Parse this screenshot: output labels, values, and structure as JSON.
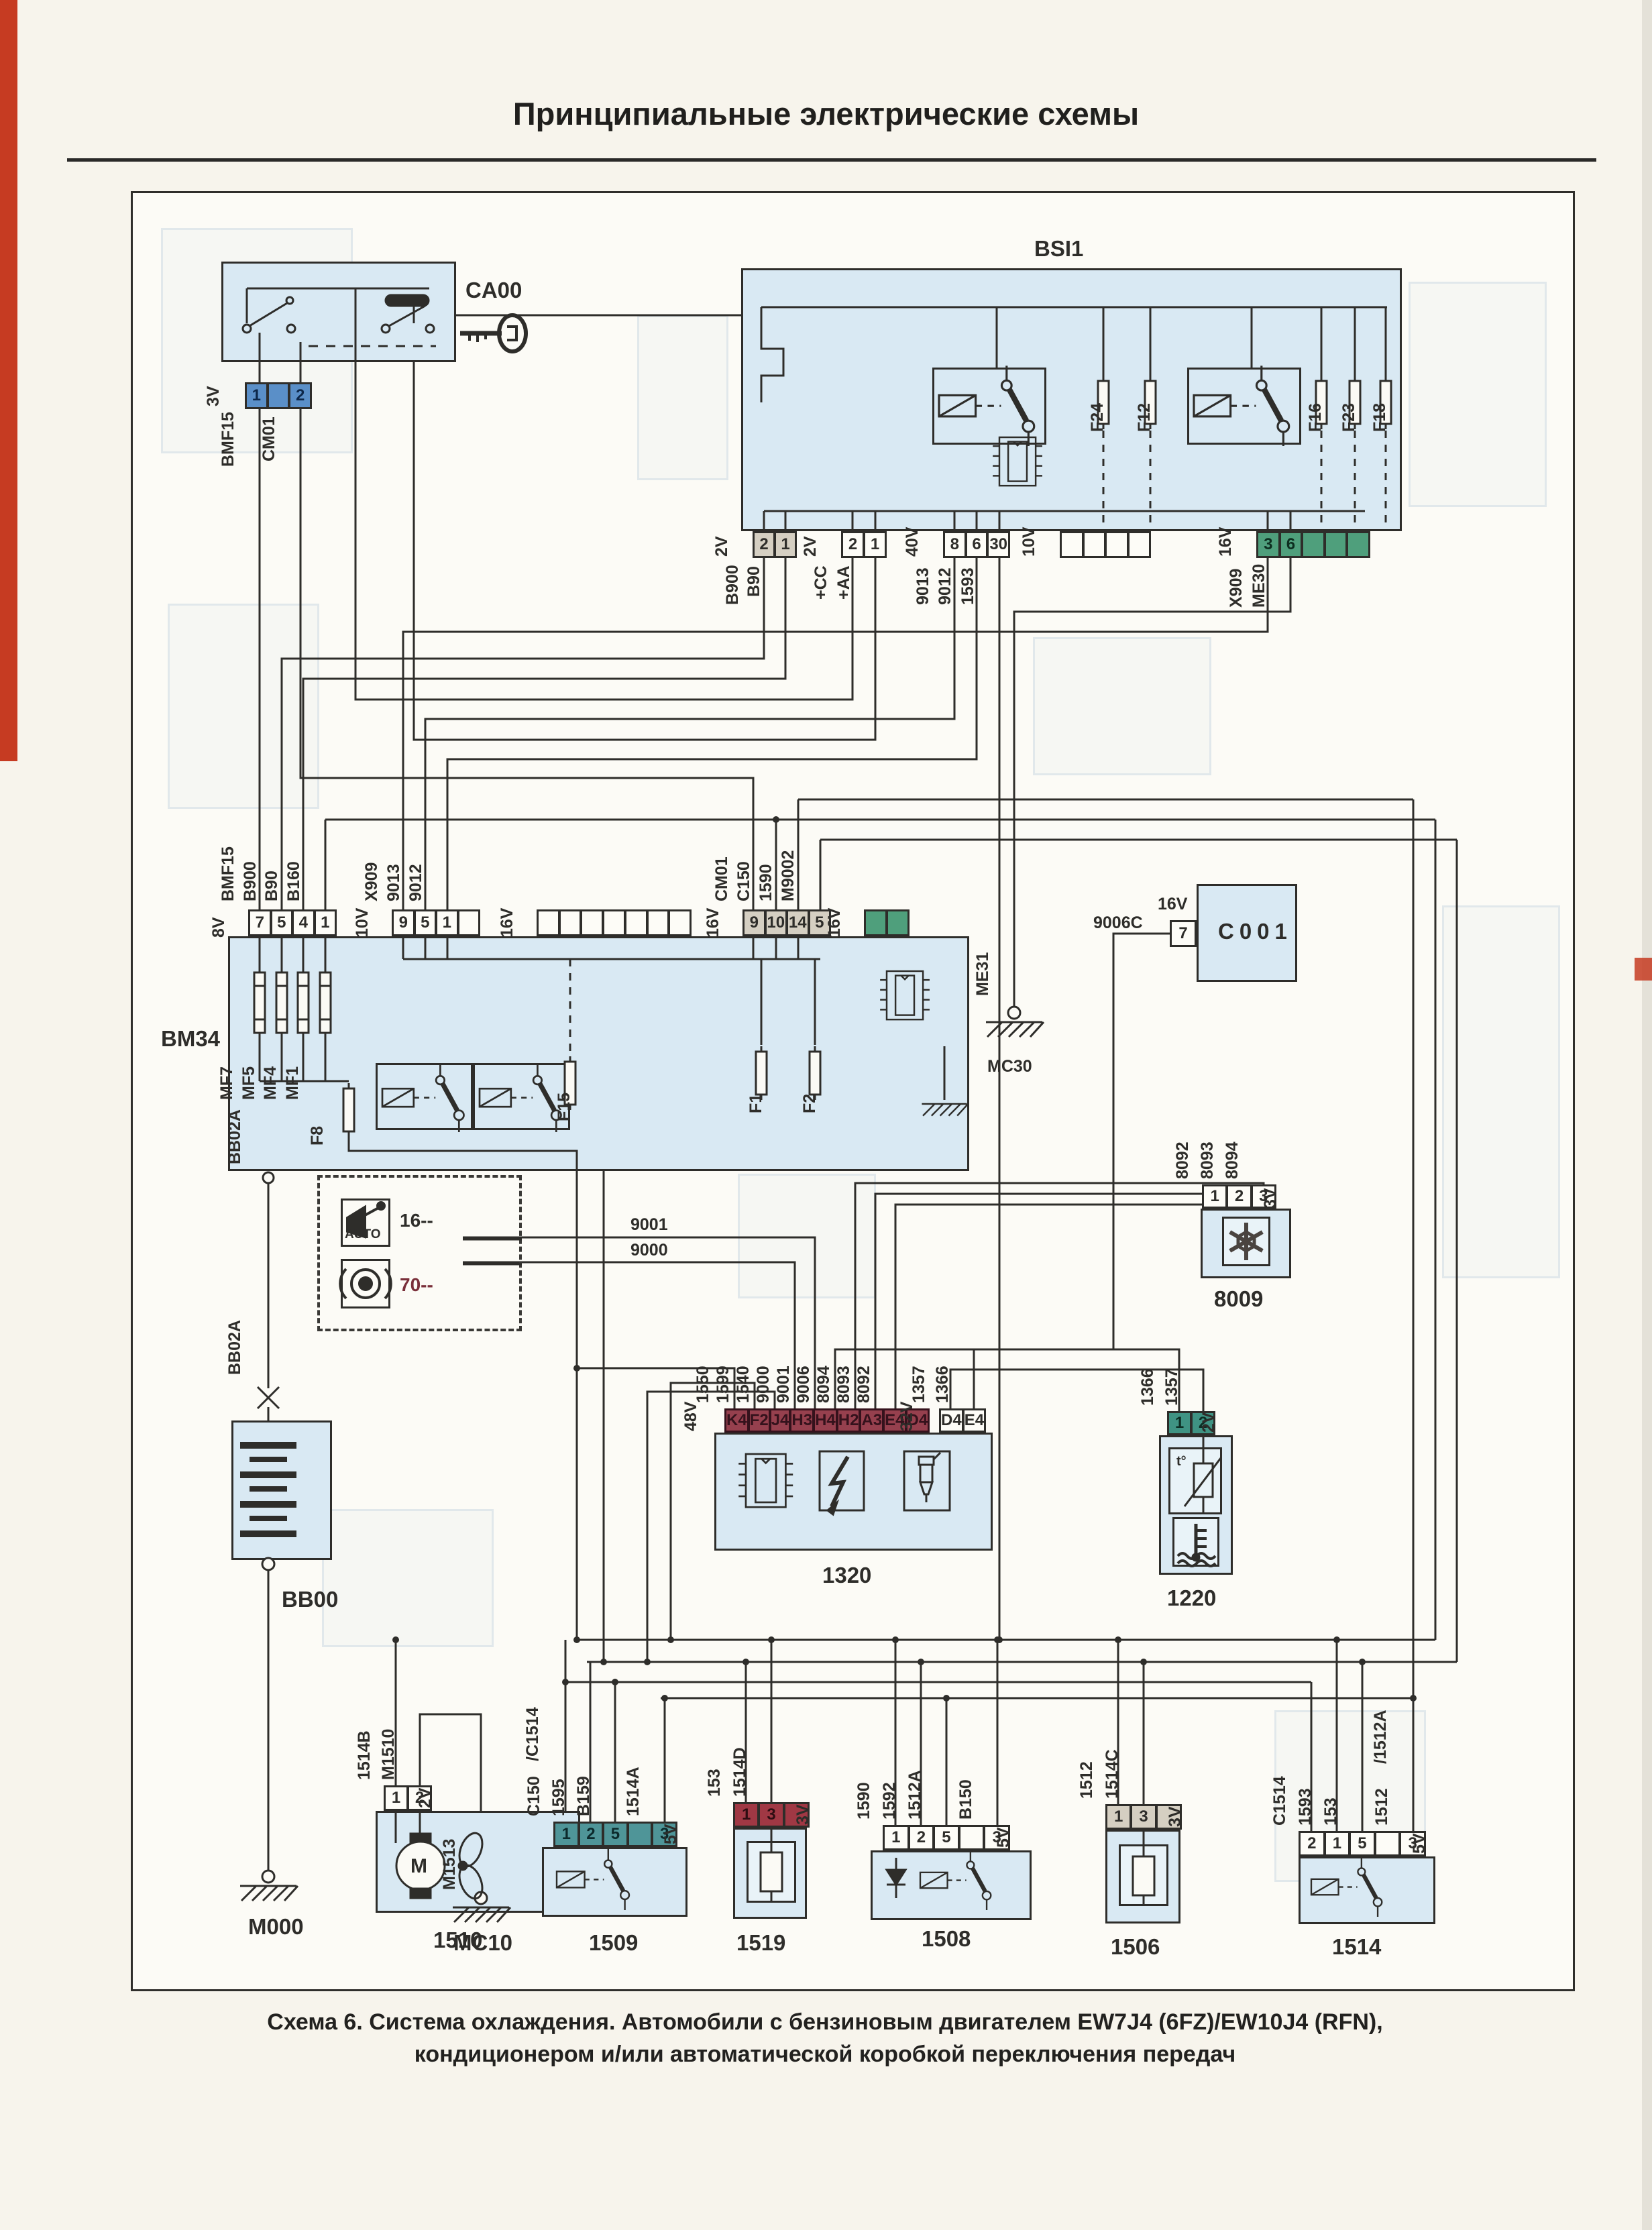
{
  "page": {
    "title": "Принципиальные электрические схемы",
    "caption_line1": "Схема 6. Система охлаждения. Автомобили с бензиновым двигателем EW7J4 (6FZ)/EW10J4 (RFN),",
    "caption_line2": "кондиционером и/или автоматической коробкой переключения передач"
  },
  "colors": {
    "line": "#2e2d2a",
    "block_fill": "#d9e9f3",
    "paper": "#f7f4ec",
    "red_stripe": "#c63b22",
    "blue_connector": "#5a8fc8",
    "green_connector": "#4f9f7c",
    "teal_connector": "#4f9598",
    "dark_red_connector": "#96404e",
    "red_connector": "#a03844",
    "gray_connector": "#d5cfc2"
  },
  "blocks": {
    "ca00": "CA00",
    "bsi1": "BSI1",
    "bm34": "BM34",
    "c001": "C001",
    "b8009": "8009",
    "b1320": "1320",
    "b1220": "1220",
    "b1510": "1510",
    "b1509": "1509",
    "b1519": "1519",
    "b1508": "1508",
    "b1506": "1506",
    "b1514": "1514",
    "bb00": "BB00"
  },
  "grounds": {
    "m000": "M000",
    "mc10": "MC10",
    "mc30": "MC30",
    "me31": "ME31"
  },
  "labels": {
    "bb02a": "BB02A",
    "m1513": "M1513",
    "w9006c": "9006C",
    "w9001": "9001",
    "w9000": "9000",
    "opt_gear": "16--",
    "opt_ring": "70--",
    "branch_c1514": "/C1514",
    "branch_1512a": "/1512A",
    "auto": "AUTO",
    "t_sensor": "t°",
    "motor": "M"
  },
  "fuses": {
    "bsi1": [
      "F24",
      "F12",
      "F16",
      "F23",
      "F18"
    ],
    "bm34_main": [
      "MF7",
      "MF5",
      "MF4",
      "MF1"
    ],
    "bm34": [
      "F8",
      "F15",
      "F1",
      "F2"
    ]
  },
  "connectors": {
    "ca00_out": {
      "voltage": "3V",
      "pins": [
        "1",
        "",
        "2"
      ],
      "wires": [
        "BMF15",
        "CM01"
      ]
    },
    "bsi1_c1": {
      "voltage": "2V",
      "pins": [
        "2",
        "1"
      ],
      "wires": [
        "B900",
        "B90"
      ]
    },
    "bsi1_c2": {
      "voltage": "2V",
      "pins": [
        "2",
        "1"
      ],
      "wires": [
        "+CC",
        "+AA"
      ]
    },
    "bsi1_c3": {
      "voltage": "40V",
      "pins": [
        "8",
        "6",
        "30"
      ],
      "wires": [
        "9013",
        "9012",
        "1593"
      ]
    },
    "bsi1_c4": {
      "voltage": "10V",
      "pins": [
        "",
        "",
        "",
        ""
      ],
      "wires": []
    },
    "bsi1_c5": {
      "voltage": "16V",
      "pins": [
        "3",
        "6",
        "",
        "",
        ""
      ],
      "wires": [
        "X909",
        "ME30"
      ]
    },
    "bm34_t1": {
      "voltage": "8V",
      "pins": [
        "7",
        "5",
        "4",
        "1"
      ],
      "wires": [
        "BMF15",
        "B900",
        "B90",
        "B160"
      ]
    },
    "bm34_t2": {
      "voltage": "10V",
      "pins": [
        "9",
        "5",
        "1",
        ""
      ],
      "wires": [
        "X909",
        "9013",
        "9012"
      ]
    },
    "bm34_t3": {
      "voltage": "16V",
      "pins": [
        "",
        "",
        "",
        "",
        "",
        "",
        ""
      ],
      "wires": []
    },
    "bm34_t4": {
      "voltage": "16V",
      "pins": [
        "9",
        "10",
        "14",
        "5"
      ],
      "wires": [
        "CM01",
        "C150",
        "1590",
        "M9002"
      ]
    },
    "bm34_t5": {
      "voltage": "16V",
      "pins": [
        "",
        ""
      ],
      "wires": []
    },
    "c001": {
      "voltage": "16V",
      "pins": [
        "7"
      ],
      "wires": [
        "9006C"
      ]
    },
    "b8009": {
      "voltage": "3V",
      "pins": [
        "1",
        "2",
        "3"
      ],
      "wires": [
        "8092",
        "8093",
        "8094"
      ]
    },
    "b1320_a": {
      "voltage": "48V",
      "pins": [
        "K4",
        "F2",
        "J4",
        "H3",
        "H4",
        "H2",
        "A3",
        "E4",
        "D4"
      ],
      "wires": [
        "1550",
        "1599",
        "1540",
        "9000",
        "9001",
        "9006",
        "8094",
        "8093",
        "8092"
      ]
    },
    "b1320_b": {
      "voltage": "32V",
      "pins": [
        "D4",
        "E4"
      ],
      "wires": [
        "1357",
        "1366"
      ]
    },
    "b1220": {
      "voltage": "2V",
      "pins": [
        "1",
        "2"
      ],
      "wires": [
        "1366",
        "1357"
      ]
    },
    "b1510": {
      "voltage": "2V",
      "pins": [
        "1",
        "2"
      ],
      "wires": [
        "1514B",
        "M1510"
      ]
    },
    "b1509": {
      "voltage": "5V",
      "pins": [
        "1",
        "2",
        "5",
        "",
        "3"
      ],
      "wires": [
        "C150",
        "1595",
        "B159",
        "",
        "1514A"
      ]
    },
    "b1519": {
      "voltage": "3V",
      "pins": [
        "1",
        "3",
        ""
      ],
      "wires": [
        "153",
        "1514D"
      ]
    },
    "b1508": {
      "voltage": "5V",
      "pins": [
        "1",
        "2",
        "5",
        "",
        "3"
      ],
      "wires": [
        "1590",
        "1592",
        "1512A",
        "",
        "B150"
      ]
    },
    "b1506": {
      "voltage": "3V",
      "pins": [
        "1",
        "3",
        ""
      ],
      "wires": [
        "1512",
        "1514C"
      ]
    },
    "b1514": {
      "voltage": "5V",
      "pins": [
        "2",
        "1",
        "5",
        "",
        "3"
      ],
      "wires": [
        "C1514",
        "1593",
        "153",
        "",
        "1512"
      ]
    }
  },
  "icons": {
    "key": "ignition-key-icon",
    "gearbox": "auto-gearbox-icon",
    "ring": "selector-ring-icon",
    "snowflake": "snowflake-icon",
    "chip": "microchip-icon",
    "lightning": "ignition-coil-icon",
    "injector": "injector-icon",
    "motor_fan": "motor-fan-icon",
    "thermistor": "coolant-temp-sensor-icon",
    "coolant": "coolant-level-icon",
    "battery": "battery-icon",
    "ground": "ground-icon",
    "relay": "relay-icon",
    "fuse": "fuse-icon"
  }
}
